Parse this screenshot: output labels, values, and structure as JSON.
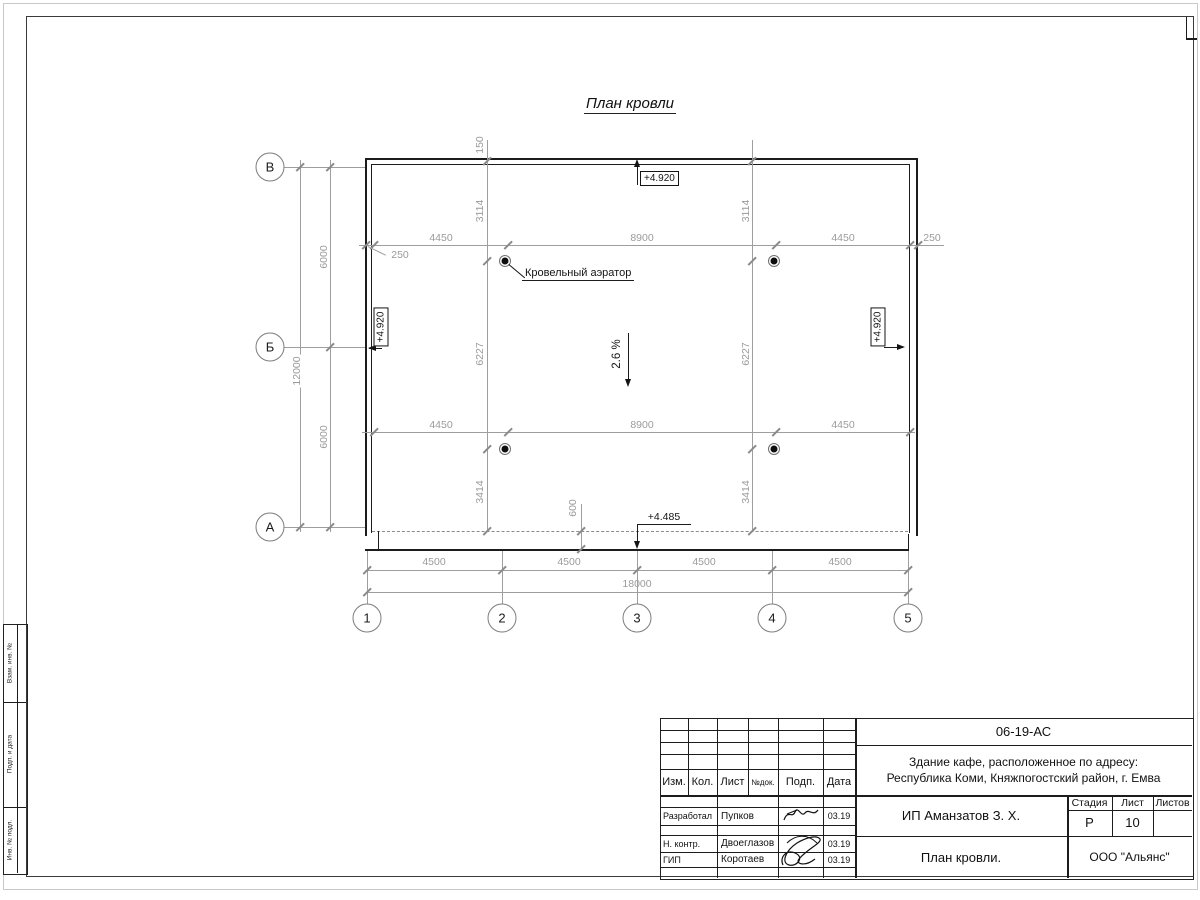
{
  "sheet": {
    "title": "План кровли"
  },
  "axes": {
    "rows": [
      "В",
      "Б",
      "А"
    ],
    "cols": [
      "1",
      "2",
      "3",
      "4",
      "5"
    ]
  },
  "dims": {
    "left": [
      "6000",
      "6000"
    ],
    "left_total": "12000",
    "bottom": [
      "4500",
      "4500",
      "4500",
      "4500"
    ],
    "bottom_total": "18000",
    "aer_top": [
      "4450",
      "8900",
      "4450"
    ],
    "aer_bottom": [
      "4450",
      "8900",
      "4450"
    ],
    "parapet": "150",
    "offset_left": "250",
    "offset_right": "250",
    "chain": [
      "3114",
      "6227",
      "3414"
    ],
    "eave_offset": "600"
  },
  "notes": {
    "aerator": "Кровельный аэратор",
    "slope": "2.6 %",
    "elev_roof": "+4.920",
    "elev_eave": "+4.485"
  },
  "titleblock": {
    "doc": "06-19-АС",
    "object1": "Здание кафе, расположенное по адресу:",
    "object2": "Республика Коми, Княжпогостский район, г. Емва",
    "client": "ИП Аманзатов З. Х.",
    "drawing": "План кровли.",
    "company": "ООО \"Альянс\"",
    "cols": [
      "Изм.",
      "Кол.",
      "Лист",
      "№док.",
      "Подп.",
      "Дата"
    ],
    "stage_cols": [
      "Стадия",
      "Лист",
      "Листов"
    ],
    "stage": "Р",
    "sheet": "10",
    "sheets": "",
    "rows": [
      {
        "role": "Разработал",
        "name": "Пупков",
        "date": "03.19"
      },
      {
        "role": "Н. контр.",
        "name": "Двоеглазов",
        "date": "03.19"
      },
      {
        "role": "ГИП",
        "name": "Коротаев",
        "date": "03.19"
      }
    ]
  },
  "margin": [
    "Взам. инв. №",
    "Подп. и дата",
    "Инв. № подл."
  ]
}
